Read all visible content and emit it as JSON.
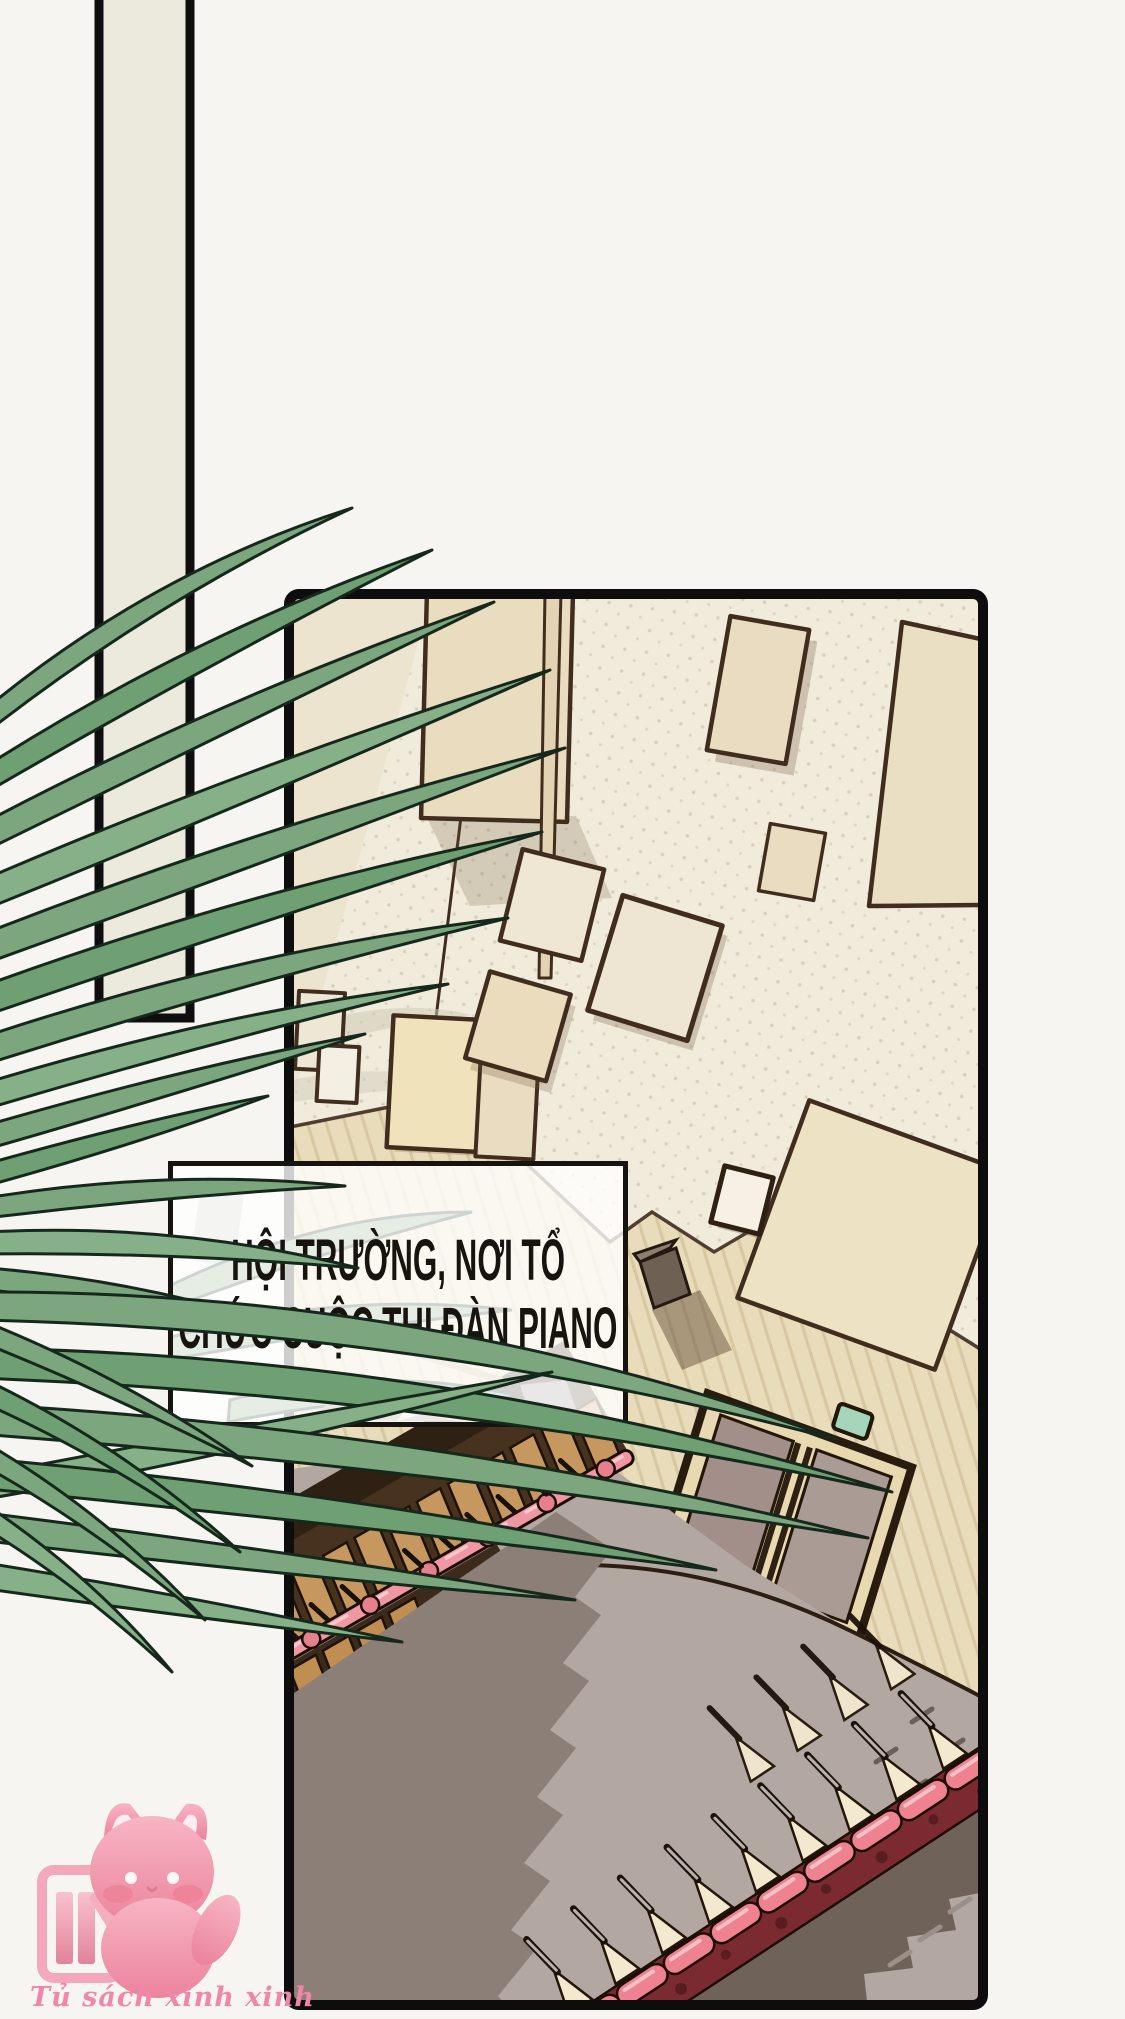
{
  "caption": {
    "line1": "HỘI TRƯỜNG, NƠI TỔ",
    "line2": "CHỨC CUỘC THI ĐÀN PIANO"
  },
  "watermark": {
    "text": "Tủ sách xinh xinh"
  },
  "palette": {
    "page_bg": "#f6f5f1",
    "caption_text": "#17130e",
    "strip_fill": "#eceadd",
    "panel_border": "#0d0d0d",
    "wall_upper": "#f1ebdb",
    "wall_lower": "#e9dcba",
    "square_tan": "#e9dcc0",
    "square_outline": "#402d1e",
    "door_frame": "#e8d9b1",
    "door_panel": "#a28f89",
    "door_sign": "#a6d6ba",
    "floor": "#b3a8a1",
    "floor_shadow": "#8b7f77",
    "floor_dark_band": "#6e6259",
    "seat_pink": "#ee8290",
    "seat_red_band": "#7c2a31",
    "seat_back_tan": "#c6975f",
    "seat_desk_cream": "#f2e9cf",
    "leaf_green": "#7ca77e",
    "leaf_outline": "#16281c",
    "logo_pink": "#f4a8bc",
    "logo_text": "#f087ab"
  }
}
